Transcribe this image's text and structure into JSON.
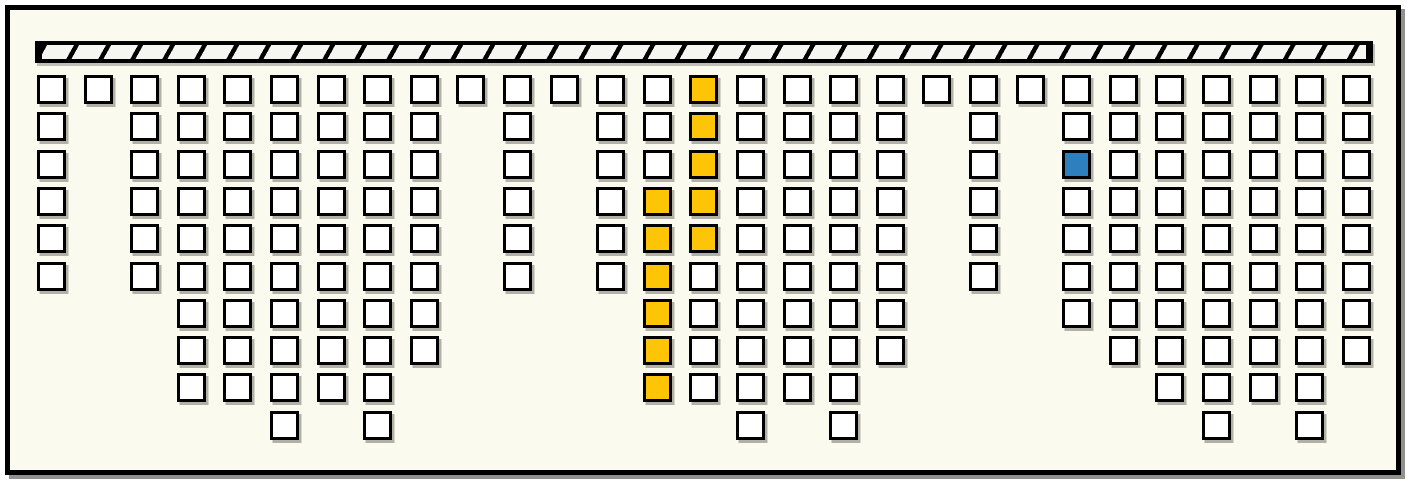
{
  "figure": {
    "kind": "hanging-cell-columns-diagram",
    "description_visible_text": "",
    "colors": {
      "outer_background": "#FFFFFF",
      "panel_fill": "#FBFAEE",
      "ink": "#000000",
      "rail_fill": "#F5F5F1",
      "cell_fill": "#FFFFFF",
      "highlight_yellow": "#FDC506",
      "highlight_blue": "#2E7FBE",
      "shadow": "#5A5850"
    },
    "rail": {
      "style": "diagonal-hatched-bar",
      "hatch_direction": "/",
      "approx_hatch_spacing_px": 32
    },
    "grid": {
      "column_count": 29,
      "max_rows": 10,
      "columns": [
        {
          "col": 0,
          "cells": 6,
          "yellow_rows": [],
          "blue_rows": []
        },
        {
          "col": 1,
          "cells": 1,
          "yellow_rows": [],
          "blue_rows": []
        },
        {
          "col": 2,
          "cells": 6,
          "yellow_rows": [],
          "blue_rows": []
        },
        {
          "col": 3,
          "cells": 9,
          "yellow_rows": [],
          "blue_rows": []
        },
        {
          "col": 4,
          "cells": 9,
          "yellow_rows": [],
          "blue_rows": []
        },
        {
          "col": 5,
          "cells": 10,
          "yellow_rows": [],
          "blue_rows": []
        },
        {
          "col": 6,
          "cells": 9,
          "yellow_rows": [],
          "blue_rows": []
        },
        {
          "col": 7,
          "cells": 10,
          "yellow_rows": [],
          "blue_rows": []
        },
        {
          "col": 8,
          "cells": 8,
          "yellow_rows": [],
          "blue_rows": []
        },
        {
          "col": 9,
          "cells": 1,
          "yellow_rows": [],
          "blue_rows": []
        },
        {
          "col": 10,
          "cells": 6,
          "yellow_rows": [],
          "blue_rows": []
        },
        {
          "col": 11,
          "cells": 1,
          "yellow_rows": [],
          "blue_rows": []
        },
        {
          "col": 12,
          "cells": 6,
          "yellow_rows": [],
          "blue_rows": []
        },
        {
          "col": 13,
          "cells": 9,
          "yellow_rows": [
            3,
            4,
            5,
            6,
            7,
            8
          ],
          "blue_rows": []
        },
        {
          "col": 14,
          "cells": 9,
          "yellow_rows": [
            0,
            1,
            2,
            3,
            4
          ],
          "blue_rows": []
        },
        {
          "col": 15,
          "cells": 10,
          "yellow_rows": [],
          "blue_rows": []
        },
        {
          "col": 16,
          "cells": 9,
          "yellow_rows": [],
          "blue_rows": []
        },
        {
          "col": 17,
          "cells": 10,
          "yellow_rows": [],
          "blue_rows": []
        },
        {
          "col": 18,
          "cells": 8,
          "yellow_rows": [],
          "blue_rows": []
        },
        {
          "col": 19,
          "cells": 1,
          "yellow_rows": [],
          "blue_rows": []
        },
        {
          "col": 20,
          "cells": 6,
          "yellow_rows": [],
          "blue_rows": []
        },
        {
          "col": 21,
          "cells": 1,
          "yellow_rows": [],
          "blue_rows": []
        },
        {
          "col": 22,
          "cells": 7,
          "yellow_rows": [],
          "blue_rows": [
            2
          ]
        },
        {
          "col": 23,
          "cells": 8,
          "yellow_rows": [],
          "blue_rows": []
        },
        {
          "col": 24,
          "cells": 9,
          "yellow_rows": [],
          "blue_rows": []
        },
        {
          "col": 25,
          "cells": 10,
          "yellow_rows": [],
          "blue_rows": []
        },
        {
          "col": 26,
          "cells": 9,
          "yellow_rows": [],
          "blue_rows": []
        },
        {
          "col": 27,
          "cells": 10,
          "yellow_rows": [],
          "blue_rows": []
        },
        {
          "col": 28,
          "cells": 8,
          "yellow_rows": [],
          "blue_rows": []
        }
      ]
    }
  }
}
